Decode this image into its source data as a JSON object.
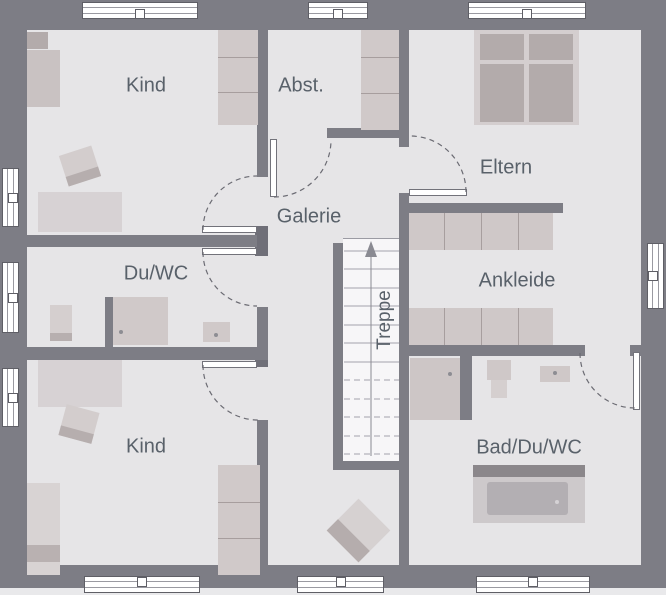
{
  "rooms": {
    "kind1": {
      "label": "Kind"
    },
    "abst": {
      "label": "Abst."
    },
    "eltern": {
      "label": "Eltern"
    },
    "galerie": {
      "label": "Galerie"
    },
    "duwc": {
      "label": "Du/WC"
    },
    "ankleide": {
      "label": "Ankleide"
    },
    "treppe": {
      "label": "Treppe"
    },
    "kind2": {
      "label": "Kind"
    },
    "bad": {
      "label": "Bad/Du/WC"
    }
  },
  "colors": {
    "wall": "#7d7d85",
    "wallDark": "#6f6f78",
    "floor": "#e6e5e7",
    "furn": "#d0c9c9",
    "furnDark": "#b3abab",
    "furnLine": "#a79e9e",
    "stair": "#f7f6f8",
    "text": "#59616a"
  }
}
